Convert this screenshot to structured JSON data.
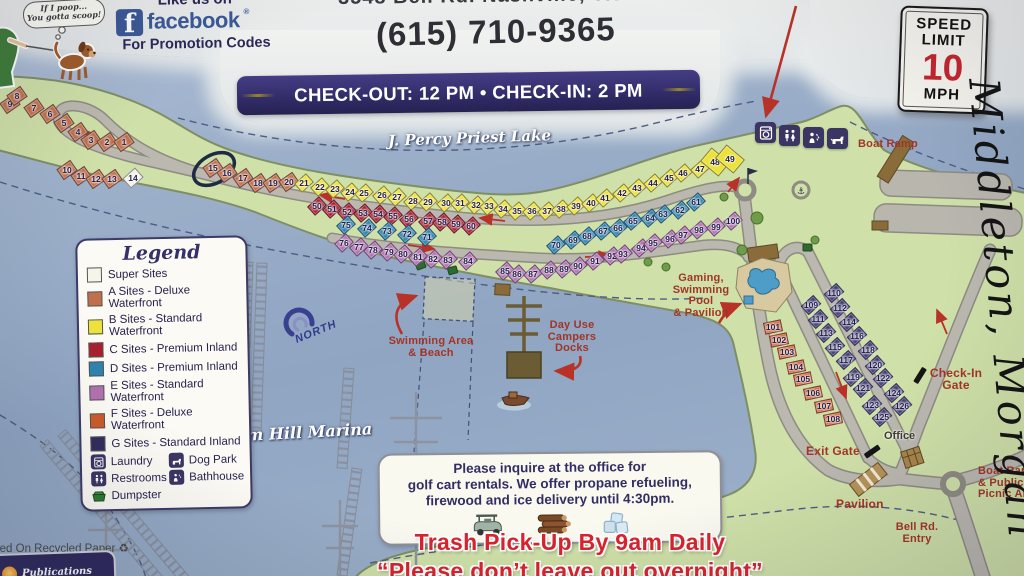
{
  "header": {
    "bubble": [
      "If I poop...",
      "You gotta scoop!"
    ],
    "facebook": {
      "like": "Like us on",
      "letter": "f",
      "brand": "facebook",
      "reg": "®",
      "promo": "For Promotion Codes"
    },
    "address_partial": "3548 Bell Rd.  Nashville, TN",
    "phone": "(615) 710-9365",
    "banner": "CHECK-OUT: 12 PM • CHECK-IN: 2 PM",
    "speed_sign": {
      "line1": "SPEED",
      "line2": "LIMIT",
      "value": "10",
      "unit": "MPH"
    }
  },
  "map": {
    "lake_name": "J. Percy Priest Lake",
    "marina_name": "Elm Hill Marina",
    "north_label": "NORTH",
    "handwriting": "Middleton, Morgan",
    "labels": {
      "boat_ramp": "Boat Ramp",
      "gaming": [
        "Gaming,",
        "Swimming",
        "Pool",
        "& Pavilion"
      ],
      "swimming": [
        "Swimming Area",
        "& Beach"
      ],
      "day_use": [
        "Day Use",
        "Campers",
        "Docks"
      ],
      "check_in": [
        "Check-In",
        "Gate"
      ],
      "exit_gate": "Exit Gate",
      "office": "Office",
      "pavilion": "Pavilion",
      "bell_rd": [
        "Bell Rd.",
        "Entry"
      ],
      "boat_picnic": [
        "Boat Ramp",
        "& Public",
        "Picnic Area"
      ]
    },
    "site_groups": [
      {
        "id": "super-sites",
        "color": "#f4f2e6",
        "rot": -42,
        "w": 15,
        "h": 11,
        "sites": [
          [
            14,
            133,
            178
          ]
        ]
      },
      {
        "id": "a-sites",
        "color": "#c0714c",
        "rot": -35,
        "w": 15,
        "h": 11,
        "sites": [
          [
            9,
            10,
            104
          ],
          [
            8,
            17,
            96
          ],
          [
            7,
            34,
            108
          ],
          [
            6,
            50,
            114
          ],
          [
            5,
            64,
            123
          ],
          [
            4,
            78,
            132
          ],
          [
            3,
            91,
            140
          ],
          [
            2,
            107,
            142
          ],
          [
            1,
            124,
            142
          ],
          [
            10,
            67,
            170
          ],
          [
            11,
            81,
            176
          ],
          [
            12,
            96,
            179
          ],
          [
            13,
            112,
            179
          ],
          [
            15,
            213,
            168
          ],
          [
            16,
            227,
            173
          ],
          [
            17,
            243,
            178
          ],
          [
            18,
            258,
            183
          ],
          [
            19,
            273,
            183
          ],
          [
            20,
            289,
            182
          ]
        ]
      },
      {
        "id": "b-sites",
        "color": "#ece23b",
        "rot": -42,
        "w": 14,
        "h": 10,
        "sites": [
          [
            21,
            304,
            183
          ],
          [
            22,
            320,
            187
          ],
          [
            23,
            335,
            189
          ],
          [
            24,
            350,
            192
          ],
          [
            25,
            364,
            193
          ],
          [
            26,
            382,
            195
          ],
          [
            27,
            397,
            197
          ],
          [
            28,
            413,
            201
          ],
          [
            29,
            428,
            202
          ],
          [
            30,
            446,
            203
          ],
          [
            31,
            460,
            203
          ],
          [
            32,
            476,
            205
          ],
          [
            33,
            489,
            206
          ],
          [
            34,
            503,
            209
          ],
          [
            35,
            517,
            211
          ],
          [
            36,
            532,
            211
          ],
          [
            37,
            547,
            211
          ],
          [
            38,
            561,
            209
          ],
          [
            39,
            576,
            206
          ],
          [
            40,
            591,
            203
          ],
          [
            41,
            605,
            198
          ],
          [
            42,
            622,
            193
          ],
          [
            43,
            637,
            188
          ],
          [
            44,
            653,
            183
          ],
          [
            45,
            669,
            178
          ],
          [
            46,
            683,
            173
          ],
          [
            47,
            700,
            169
          ]
        ]
      },
      {
        "id": "b-sites-large",
        "color": "#ece23b",
        "rot": -50,
        "w": 16,
        "h": 22,
        "sites": [
          [
            48,
            715,
            162
          ],
          [
            49,
            730,
            159
          ]
        ]
      },
      {
        "id": "c-sites",
        "color": "#a91f2e",
        "rot": -42,
        "w": 14,
        "h": 10,
        "sites": [
          [
            50,
            317,
            206
          ],
          [
            51,
            332,
            209
          ],
          [
            52,
            347,
            212
          ],
          [
            53,
            363,
            213
          ],
          [
            54,
            378,
            214
          ],
          [
            55,
            393,
            216
          ],
          [
            56,
            409,
            219
          ],
          [
            57,
            428,
            221
          ],
          [
            58,
            442,
            222
          ],
          [
            59,
            456,
            224
          ],
          [
            60,
            471,
            226
          ]
        ]
      },
      {
        "id": "d-sites",
        "color": "#2e84ad",
        "rot": -42,
        "w": 14,
        "h": 10,
        "sites": [
          [
            75,
            346,
            225
          ],
          [
            74,
            367,
            228
          ],
          [
            73,
            387,
            231
          ],
          [
            72,
            407,
            234
          ],
          [
            71,
            427,
            237
          ],
          [
            70,
            556,
            245
          ],
          [
            69,
            573,
            240
          ],
          [
            68,
            587,
            236
          ],
          [
            67,
            603,
            231
          ],
          [
            66,
            618,
            228
          ],
          [
            65,
            633,
            221
          ],
          [
            64,
            650,
            218
          ],
          [
            63,
            663,
            214
          ],
          [
            62,
            680,
            210
          ],
          [
            61,
            696,
            202
          ]
        ]
      },
      {
        "id": "e-sites",
        "color": "#b272ae",
        "rot": -42,
        "w": 14,
        "h": 10,
        "sites": [
          [
            76,
            344,
            243
          ],
          [
            77,
            359,
            247
          ],
          [
            78,
            373,
            250
          ],
          [
            79,
            389,
            252
          ],
          [
            80,
            403,
            254
          ],
          [
            81,
            418,
            257
          ],
          [
            82,
            433,
            259
          ],
          [
            83,
            448,
            260
          ],
          [
            84,
            468,
            261
          ],
          [
            85,
            505,
            271
          ],
          [
            86,
            517,
            274
          ],
          [
            87,
            533,
            274
          ],
          [
            88,
            549,
            270
          ],
          [
            89,
            564,
            269
          ],
          [
            90,
            578,
            266
          ],
          [
            91,
            595,
            261
          ],
          [
            92,
            612,
            256
          ],
          [
            93,
            623,
            254
          ],
          [
            94,
            641,
            248
          ],
          [
            95,
            653,
            243
          ],
          [
            96,
            670,
            239
          ],
          [
            97,
            683,
            235
          ],
          [
            98,
            699,
            230
          ],
          [
            99,
            716,
            227
          ],
          [
            100,
            733,
            221
          ]
        ]
      },
      {
        "id": "f-sites",
        "color": "#cc5c2a",
        "rot": -12,
        "w": 16,
        "h": 10,
        "sites": [
          [
            101,
            773,
            327
          ],
          [
            102,
            779,
            340
          ],
          [
            103,
            787,
            352
          ],
          [
            104,
            796,
            367
          ],
          [
            105,
            803,
            379
          ],
          [
            106,
            813,
            393
          ],
          [
            107,
            824,
            406
          ],
          [
            108,
            833,
            419
          ]
        ]
      },
      {
        "id": "g-sites",
        "color": "#433d73",
        "rot": -42,
        "w": 15,
        "h": 10,
        "sites": [
          [
            109,
            811,
            305
          ],
          [
            110,
            834,
            293
          ],
          [
            111,
            818,
            319
          ],
          [
            112,
            840,
            308
          ],
          [
            113,
            826,
            333
          ],
          [
            114,
            849,
            322
          ],
          [
            115,
            835,
            347
          ],
          [
            116,
            857,
            336
          ],
          [
            117,
            846,
            360
          ],
          [
            118,
            868,
            350
          ],
          [
            119,
            853,
            377
          ],
          [
            120,
            875,
            365
          ],
          [
            121,
            863,
            388
          ],
          [
            122,
            883,
            378
          ],
          [
            123,
            872,
            405
          ],
          [
            124,
            894,
            393
          ],
          [
            125,
            882,
            417
          ],
          [
            126,
            902,
            406
          ]
        ]
      }
    ]
  },
  "legend": {
    "title": "Legend",
    "rows": [
      {
        "swatch": "#f7f5ea",
        "label": "Super Sites"
      },
      {
        "swatch": "#c0714c",
        "label": "A Sites - Deluxe Waterfront"
      },
      {
        "swatch": "#ece23b",
        "label": "B Sites - Standard Waterfront"
      },
      {
        "swatch": "#a91f2e",
        "label": "C Sites - Premium Inland"
      },
      {
        "swatch": "#2e84ad",
        "label": "D Sites - Premium Inland"
      },
      {
        "swatch": "#b272ae",
        "label": "E Sites - Standard Waterfront"
      },
      {
        "swatch": "#cc5c2a",
        "label": "F Sites - Deluxe Waterfront"
      },
      {
        "swatch": "#322d5e",
        "label": "G Sites - Standard Inland"
      }
    ],
    "amenities": [
      {
        "icon": "laundry-icon",
        "label": "Laundry"
      },
      {
        "icon": "dog-park-icon",
        "label": "Dog Park"
      },
      {
        "icon": "restrooms-icon",
        "label": "Restrooms"
      },
      {
        "icon": "bathhouse-icon",
        "label": "Bathhouse"
      },
      {
        "icon": "dumpster-icon",
        "label": "Dumpster"
      }
    ]
  },
  "notice": {
    "lines": [
      "Please inquire at the office for",
      "golf cart rentals. We offer propane refueling,",
      "firewood and ice delivery until 4:30pm."
    ]
  },
  "footer": {
    "trash_line1": "Trash Pick-Up By 9am Daily",
    "trash_line2": "“Please don’t leave out overnight”",
    "recycled": "Printed On Recycled Paper ♻",
    "publisher": "Publications"
  }
}
